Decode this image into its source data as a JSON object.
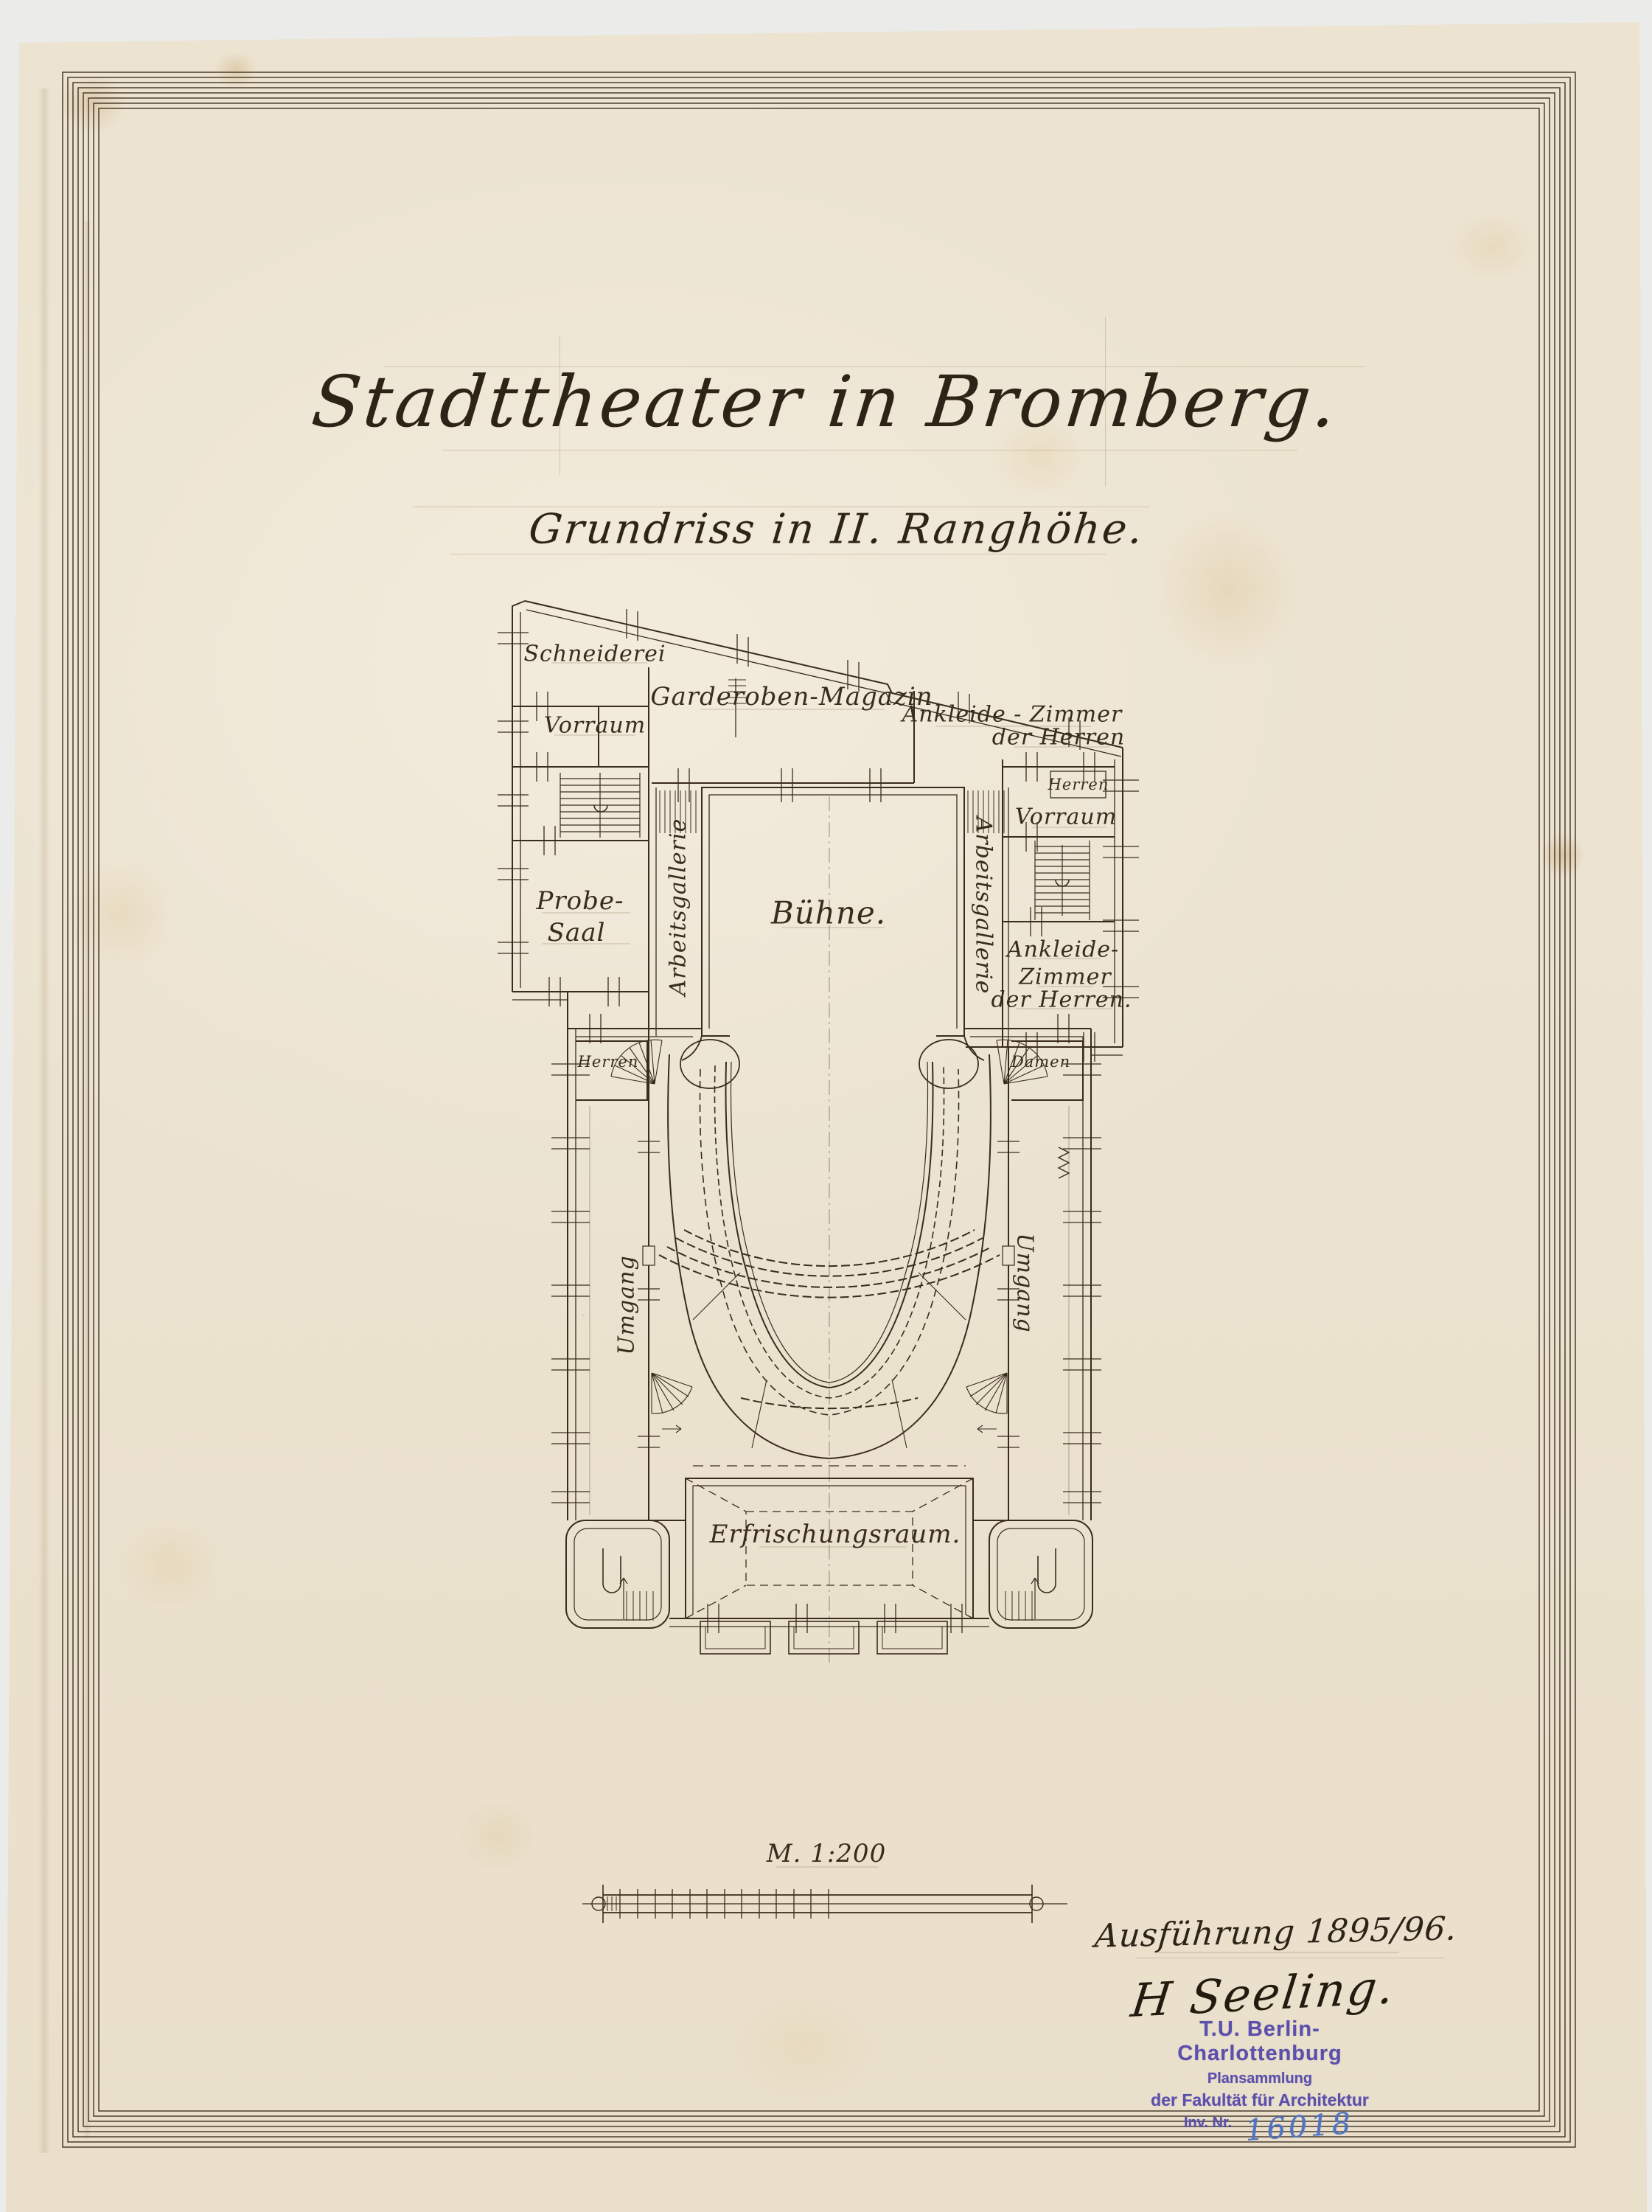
{
  "document": {
    "title": "Stadttheater in Bromberg.",
    "subtitle": "Grundriss in II. Ranghöhe.",
    "scale_label": "M. 1:200",
    "execution_note": "Ausführung 1895/96.",
    "signature": "H Seeling."
  },
  "plan": {
    "rooms": {
      "schneiderei": "Schneiderei",
      "vorraum_left": "Vorraum",
      "garderoben_magazin": "Garderoben-Magazin",
      "ankleide_top_line1": "Ankleide - Zimmer",
      "ankleide_top_line2": "der Herren",
      "herren_closet": "Herren",
      "vorraum_right": "Vorraum",
      "probe_saal_line1": "Probe-",
      "probe_saal_line2": "Saal",
      "buehne": "Bühne.",
      "arbeitsgallerie_left": "Arbeitsgallerie",
      "arbeitsgallerie_right": "Arbeitsgallerie",
      "ankleide_bottom_line1": "Ankleide-",
      "ankleide_bottom_line2": "Zimmer",
      "ankleide_bottom_line3": "der Herren.",
      "herren_foyer": "Herren",
      "damen_foyer": "Damen",
      "umgang_left": "Umgang",
      "umgang_right": "Umgang",
      "erfrischungsraum": "Erfrischungsraum."
    }
  },
  "stamp": {
    "line1": "T.U. Berlin-Charlottenburg",
    "line2": "Plansammlung",
    "line3": "der Fakultät für Architektur",
    "line4": "Inv. Nr.",
    "inventory_number": "16018"
  },
  "colors": {
    "paper": "#ece3d1",
    "ink": "#3a2c1d",
    "stamp_purple": "#5b50ab",
    "inventory_blue": "#4d74c6",
    "scan_background": "#ebebe9"
  }
}
